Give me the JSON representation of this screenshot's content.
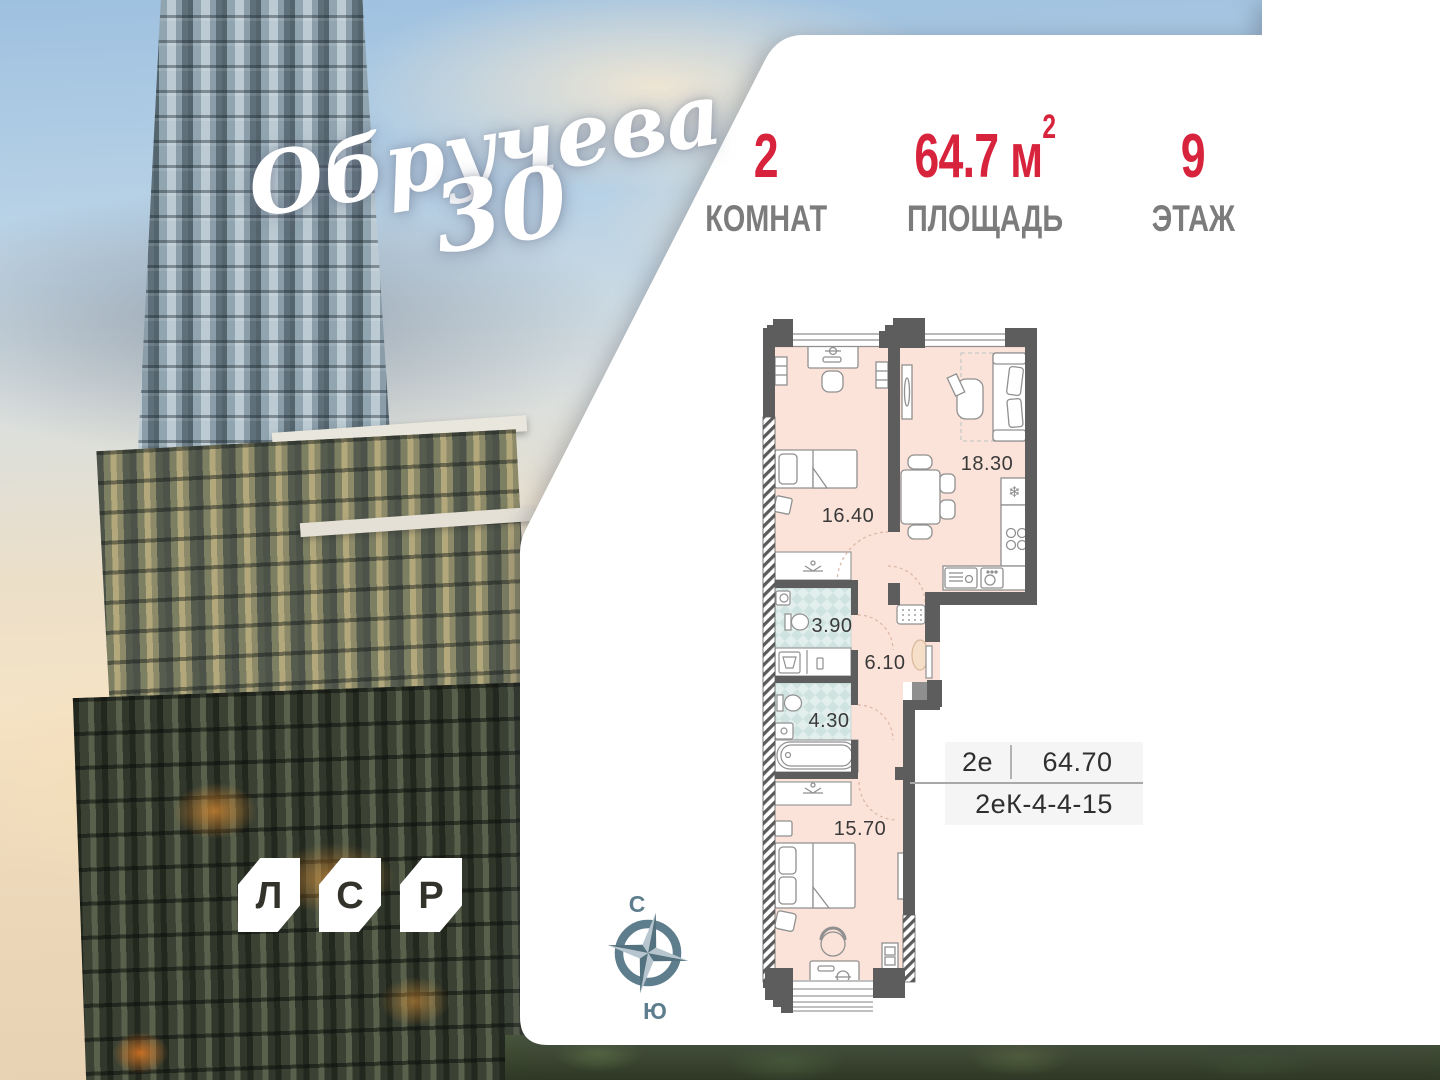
{
  "project": {
    "script_name": "Обручева",
    "script_number": "30"
  },
  "stats": {
    "rooms": {
      "value": "2",
      "label": "КОМНАТ"
    },
    "area": {
      "value": "64.7",
      "unit": "м",
      "sup": "2",
      "label": "ПЛОЩАДЬ"
    },
    "floor": {
      "value": "9",
      "label": "ЭТАЖ"
    }
  },
  "plan": {
    "rooms": [
      {
        "name": "bedroom-1",
        "area": "16.40"
      },
      {
        "name": "living-kitchen",
        "area": "18.30"
      },
      {
        "name": "bathroom",
        "area": "3.90"
      },
      {
        "name": "hallway",
        "area": "6.10"
      },
      {
        "name": "wc",
        "area": "4.30"
      },
      {
        "name": "bedroom-2",
        "area": "15.70"
      }
    ],
    "icons": {
      "fridge_snowflake": "❄"
    }
  },
  "spec": {
    "type": "2е",
    "area": "64.70",
    "code": "2еК-4-4-15"
  },
  "compass": {
    "north": "С",
    "south": "Ю"
  },
  "developer": {
    "letters": [
      "Л",
      "С",
      "Р"
    ]
  },
  "colors": {
    "accent_red": "#d8233d",
    "wall": "#5d5d5d",
    "floor": "#fce3d9",
    "tile": "#cfe3e0",
    "compass": "#5e7d8d"
  }
}
